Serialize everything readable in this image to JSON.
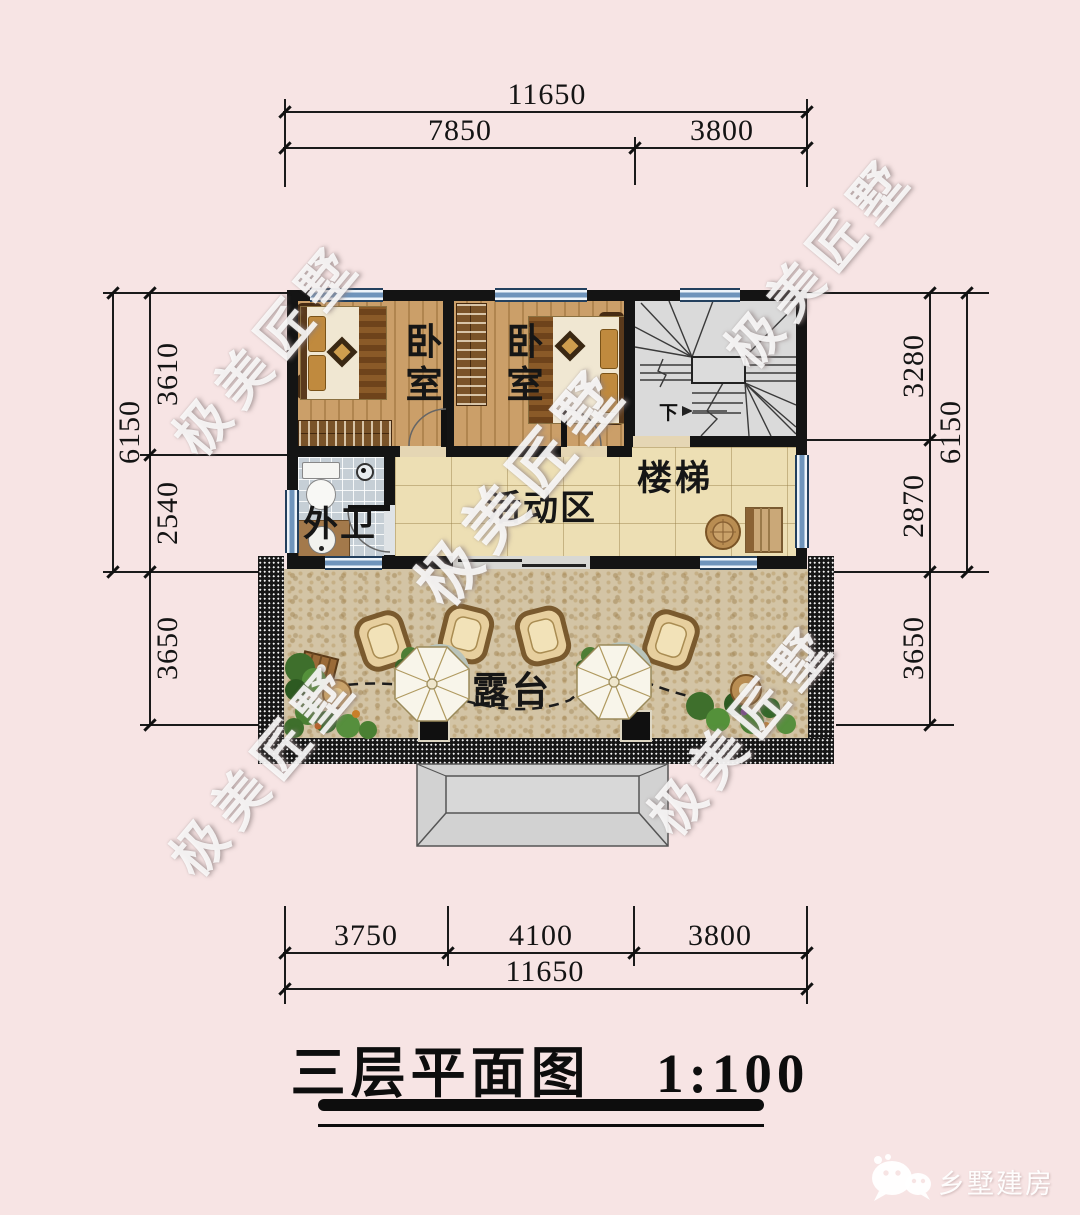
{
  "colors": {
    "background": "#f7e4e4",
    "wall": "#141414",
    "window_blue": "#6f94bb",
    "wood_floor": "#c59a64",
    "activity_floor": "#eddfb4",
    "terrace_floor": "#d3c4a5",
    "stair_floor": "#dadada",
    "line": "#1a1a1a",
    "watermark": "#ffffff"
  },
  "title": {
    "text": "三层平面图",
    "scale": "1:100"
  },
  "dimensions": {
    "top": {
      "total": "11650",
      "segments": [
        "7850",
        "3800"
      ]
    },
    "bottom": {
      "total": "11650",
      "segments": [
        "3750",
        "4100",
        "3800"
      ]
    },
    "left": {
      "overall": "6150",
      "segments": [
        "3610",
        "2540",
        "3650"
      ]
    },
    "right": {
      "overall": "6150",
      "segments": [
        "3280",
        "2870",
        "3650"
      ]
    }
  },
  "rooms": {
    "bedroom1": "卧室",
    "bedroom2": "卧室",
    "stairs": "楼梯",
    "activity": "活动区",
    "bathroom": "外卫",
    "terrace": "露台"
  },
  "annotations": {
    "stair_down": "下"
  },
  "watermark": {
    "text": "极美匠墅"
  },
  "footer": {
    "brand": "乡墅建房",
    "icon": "wechat-icon"
  }
}
